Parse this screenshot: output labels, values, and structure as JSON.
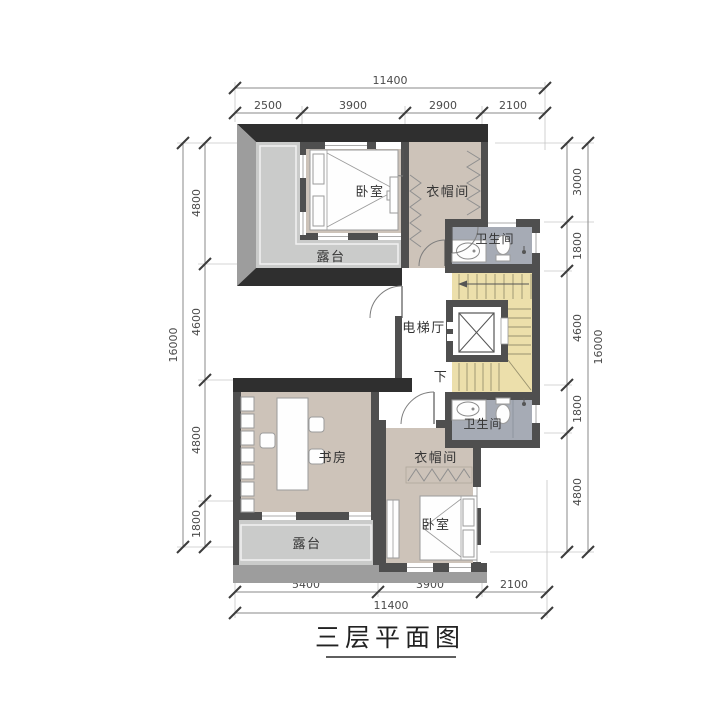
{
  "title": {
    "text": "三层平面图"
  },
  "dims": {
    "top": {
      "total": "11400",
      "segments": [
        "2500",
        "3900",
        "2900",
        "2100"
      ]
    },
    "bottom": {
      "total": "11400",
      "segments": [
        "5400",
        "3900",
        "2100"
      ]
    },
    "left": {
      "total": "16000",
      "segments": [
        "4800",
        "4600",
        "4800",
        "1800"
      ]
    },
    "right": {
      "total": "16000",
      "segments": [
        "3000",
        "1800",
        "4600",
        "1800",
        "4800"
      ]
    }
  },
  "rooms": {
    "bedroom_upper": "卧室",
    "cloakroom_upper": "衣帽间",
    "bathroom_upper": "卫生间",
    "elevator_hall": "电梯厅",
    "stairs_down_label": "下",
    "bathroom_lower": "卫生间",
    "cloakroom_lower": "衣帽间",
    "bedroom_lower": "卧室",
    "study": "书房",
    "terrace_upper": "露台",
    "terrace_lower": "露台"
  },
  "colors": {
    "wall": "#4f4f4f",
    "roof_edge": "#2f2f2f",
    "parapet": "#9d9d9d",
    "room_floor": "#cdc3b9",
    "terrace_floor": "#cacbca",
    "bathroom_floor": "#a6abb5",
    "stair_floor": "#ecdfab"
  }
}
